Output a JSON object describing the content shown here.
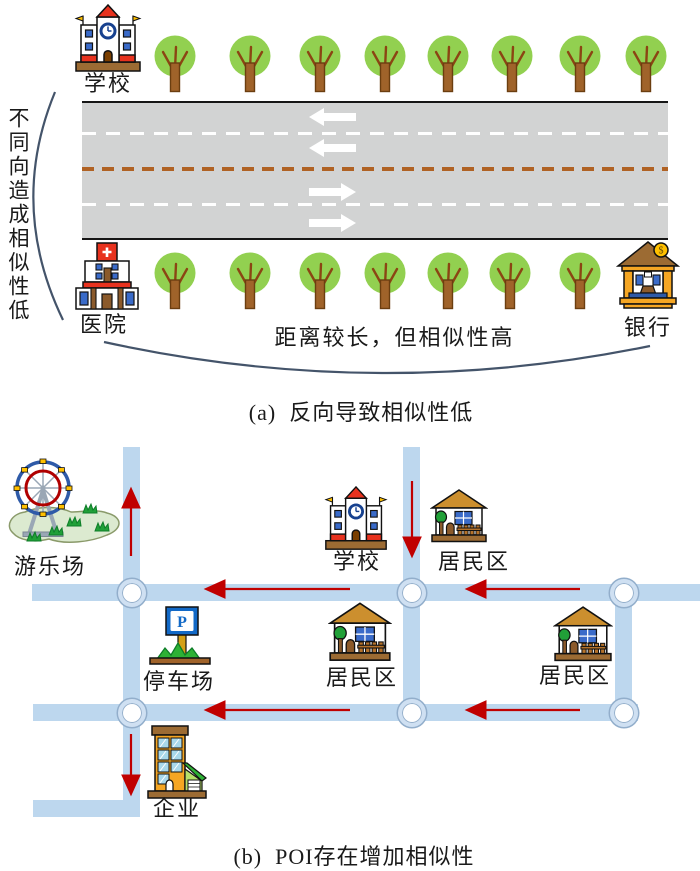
{
  "figure": {
    "panel_a": {
      "caption": "(a)  反向导致相似性低",
      "side_note": "不同向造成相似性低",
      "arc_note": "距离较长，但相似性高",
      "school_label": "学校",
      "hospital_label": "医院",
      "bank_label": "银行",
      "bank_coin_symbol": "$"
    },
    "panel_b": {
      "caption": "(b)  POI存在增加相似性",
      "amusement_park_label": "游乐场",
      "school_label": "学校",
      "residential_label_1": "居民区",
      "residential_label_2": "居民区",
      "residential_label_3": "居民区",
      "parking_label": "停车场",
      "parking_sign_letter": "P",
      "enterprise_label": "企业"
    },
    "colors": {
      "road_surface_gray": "#d2d3d3",
      "lane_marking_white": "#ffffff",
      "lane_center_line_brown": "#b06224",
      "map_road_blue": "#bdd7ee",
      "direction_arrow_red": "#c00000",
      "annotation_curve_blue": "#44546a",
      "tree_crown_green": "#92d050"
    }
  }
}
